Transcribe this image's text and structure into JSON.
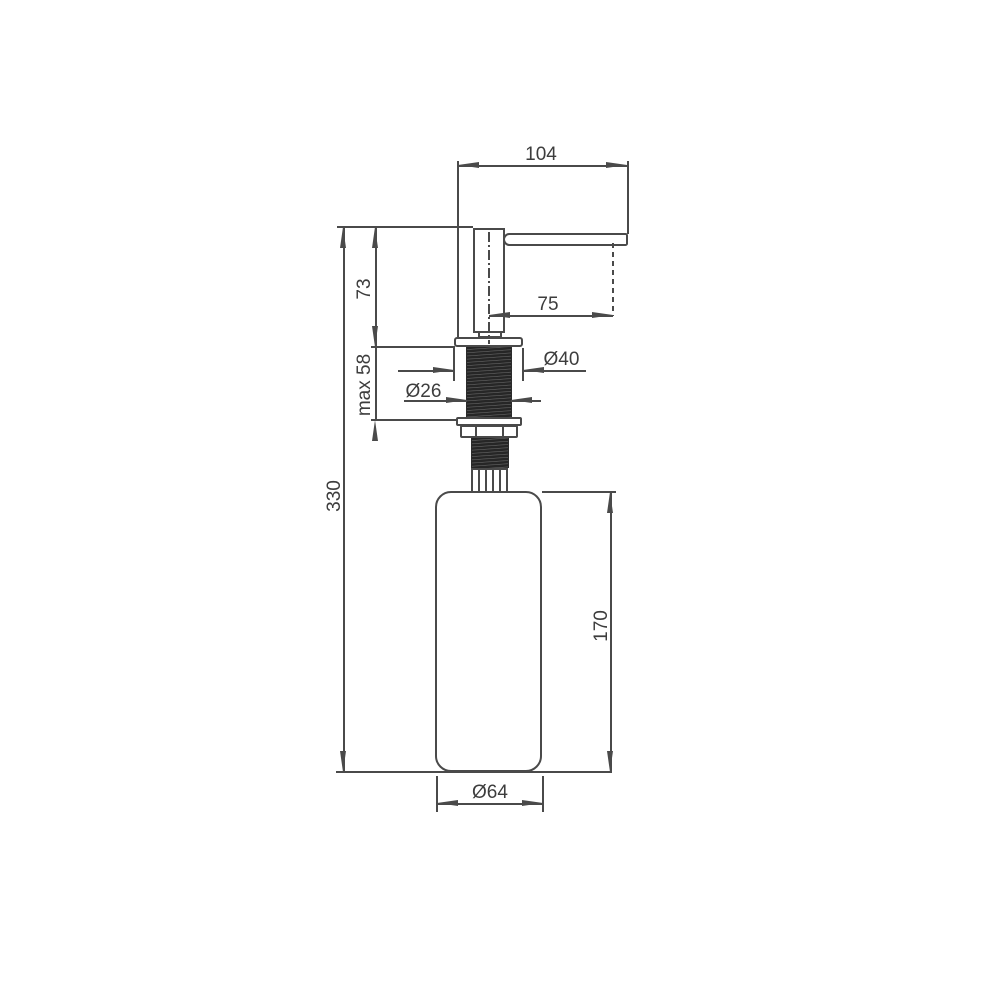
{
  "drawing": {
    "background": "#ffffff",
    "line_color": "#4a4a4a",
    "text_color": "#3d3d3d",
    "thread_color": "#2b2b2b",
    "dimensions": {
      "head_width": "104",
      "spout_projection": "75",
      "flange_diameter": "Ø40",
      "thread_diameter": "Ø26",
      "head_height": "73",
      "max_mounting_thickness": "max 58",
      "total_height": "330",
      "bottle_height": "170",
      "bottle_diameter": "Ø64"
    }
  }
}
